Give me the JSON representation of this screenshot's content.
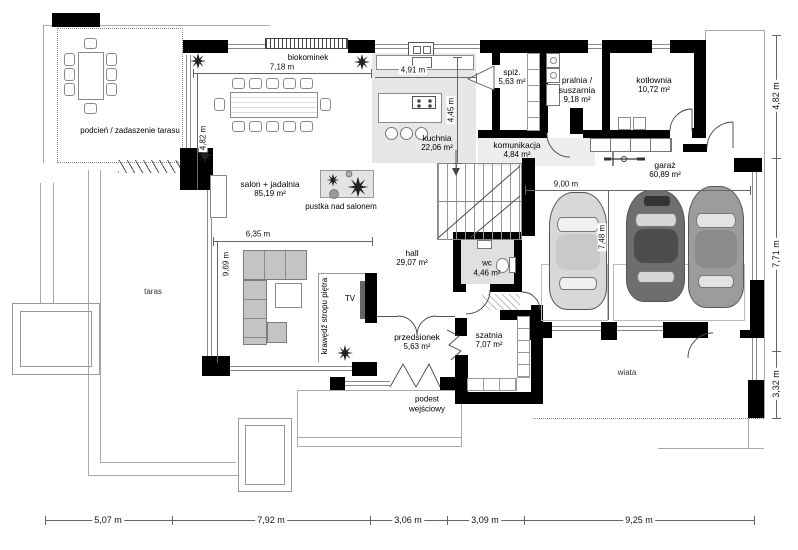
{
  "rooms": [
    {
      "label": "podcień / zadaszenie tarasu",
      "area": ""
    },
    {
      "label": "salon + jadalnia",
      "area": "85,19 m²"
    },
    {
      "label": "kuchnia",
      "area": "22,06 m²"
    },
    {
      "label": "spiż.",
      "area": "5,63 m²"
    },
    {
      "label": "pralnia / suszarnia",
      "area": "9,18 m²"
    },
    {
      "label": "kotłownia",
      "area": "10,72 m²"
    },
    {
      "label": "komunikacja",
      "area": "4,84 m²"
    },
    {
      "label": "garaż",
      "area": "60,89 m²"
    },
    {
      "label": "hall",
      "area": "29,07 m²"
    },
    {
      "label": "wc",
      "area": "4,46 m²"
    },
    {
      "label": "przedsionek",
      "area": "5,63 m²"
    },
    {
      "label": "szatnia",
      "area": "7,07 m²"
    }
  ],
  "annotations": {
    "biokominek": "biokominek",
    "pustka": "pustka nad salonem",
    "tv": "TV",
    "krawedz": "krawędź stropu piętra",
    "taras": "taras",
    "wiata": "wiata",
    "podest": "podest wejściowy"
  },
  "dimensions": {
    "bottom": [
      "5,07 m",
      "7,92 m",
      "3,06 m",
      "3,09 m",
      "9,25 m"
    ],
    "right": [
      "4,82 m",
      "7,71 m",
      "3,32 m"
    ],
    "inner": {
      "salon_top": "7,18 m",
      "kitchen_top": "4,91 m",
      "kitchen_right": "4,45 m",
      "salon_left": "4,82 m",
      "salon_mid": "6,35 m",
      "salon_left_lower": "9,69 m",
      "garage_top": "9,00 m",
      "garage_left": "7,48 m"
    }
  },
  "colors": {
    "wall": "#000000",
    "room_fill": "#e7e7e7",
    "line": "#9a9a9a",
    "car_light": "#d8d8d8",
    "car_dark": "#6e6e6e",
    "car_mid": "#9c9c9c"
  }
}
